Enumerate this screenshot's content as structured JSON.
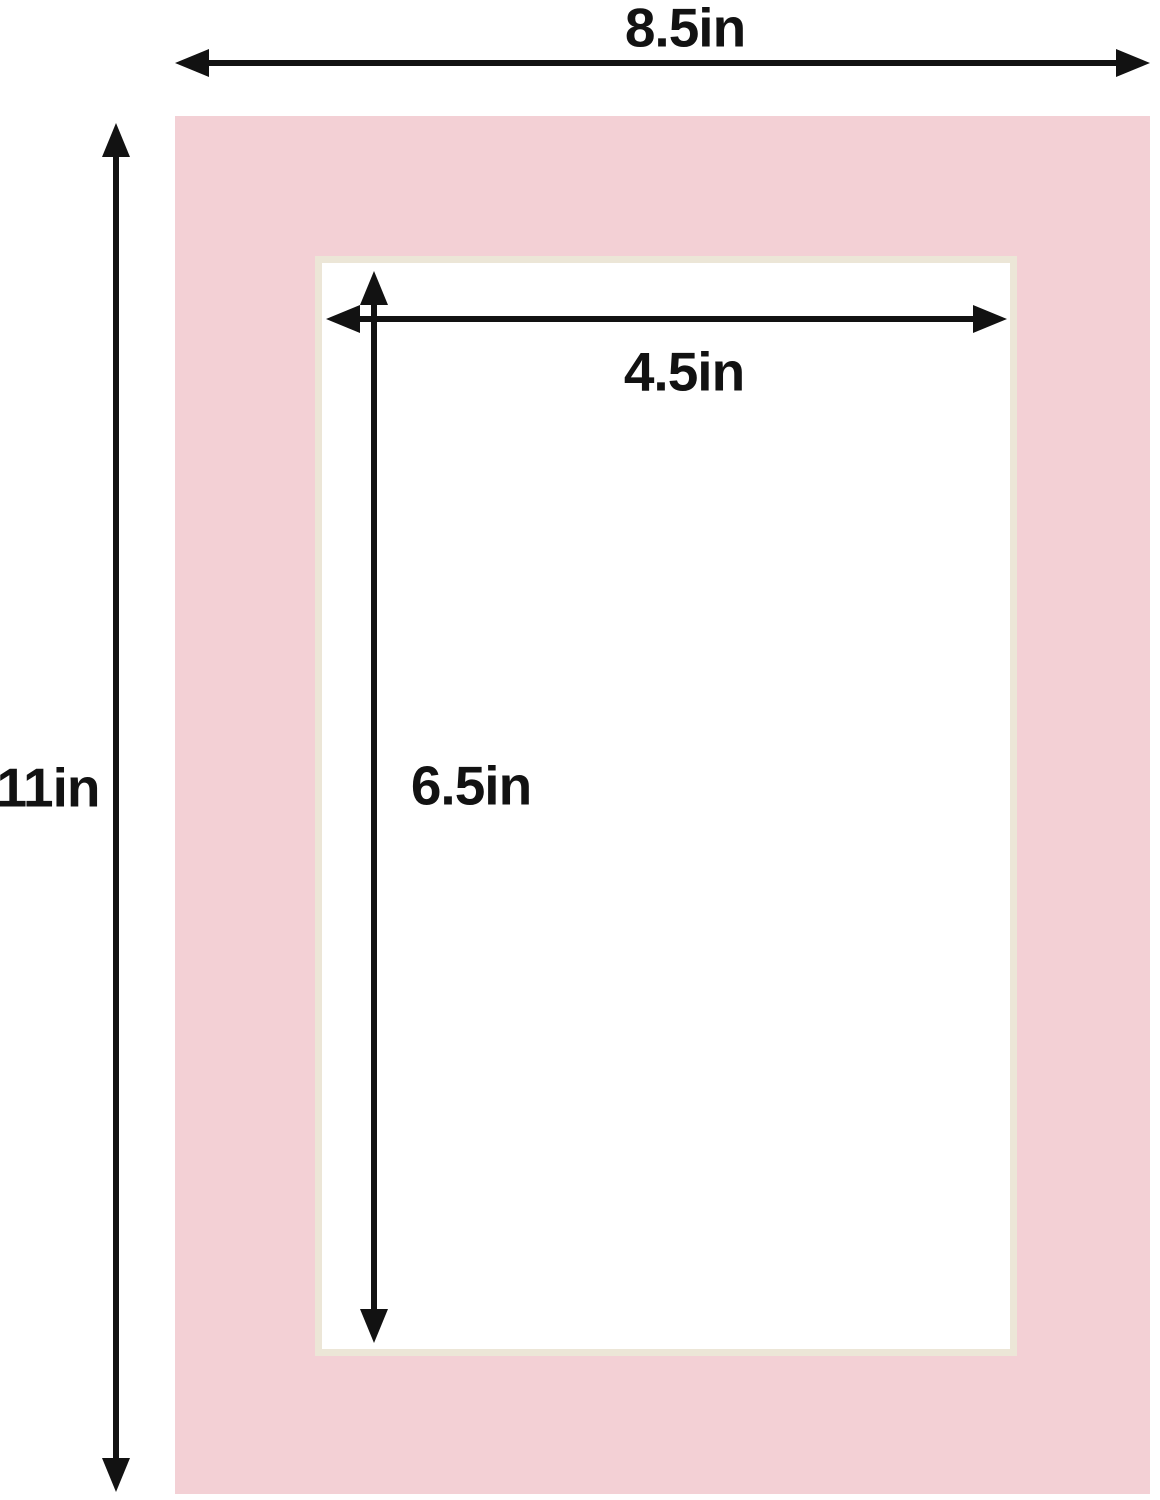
{
  "diagram": {
    "type": "picture-mat-dimension-diagram",
    "mat": {
      "outer_width": "8.5in",
      "outer_height": "11in",
      "opening_width": "4.5in",
      "opening_height": "6.5in"
    },
    "colors": {
      "mat": "#f3d0d5",
      "bevel": "#ece6d7",
      "dimension": "#121212",
      "background": "#ffffff"
    }
  }
}
